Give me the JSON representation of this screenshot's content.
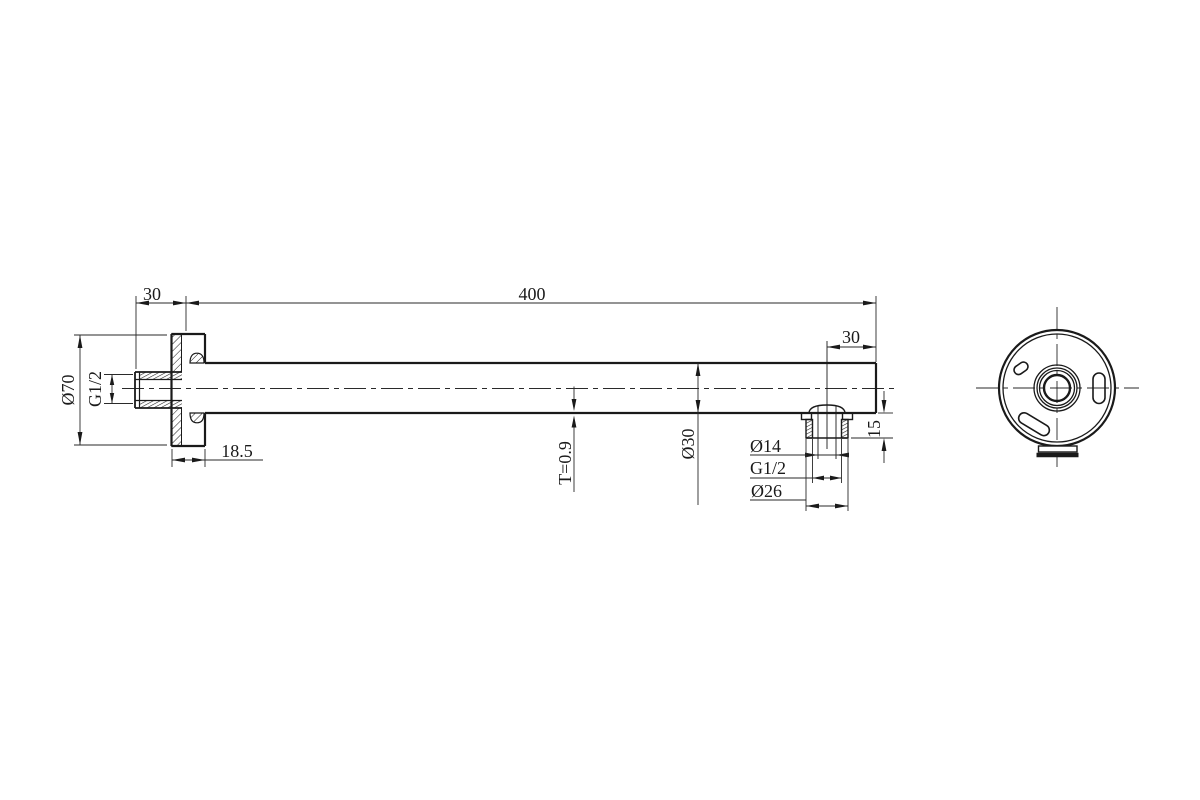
{
  "page": {
    "background": "#ffffff",
    "line_color": "#1a1a1a"
  },
  "drawing": {
    "name": "wall-mounted shower arm two-view engineering drawing",
    "dims": {
      "inlet_stub_length": "30",
      "arm_length": "400",
      "flange_diameter": "Ø70",
      "inlet_thread": "G1/2",
      "flange_depth": "18.5",
      "tube_wall_thickness": "T=0.9",
      "tube_diameter": "Ø30",
      "outlet_orifice": "Ø14",
      "outlet_thread": "G1/2",
      "outlet_outer_diameter": "Ø26",
      "outlet_offset_from_end": "30",
      "outlet_stub_height": "15"
    }
  }
}
